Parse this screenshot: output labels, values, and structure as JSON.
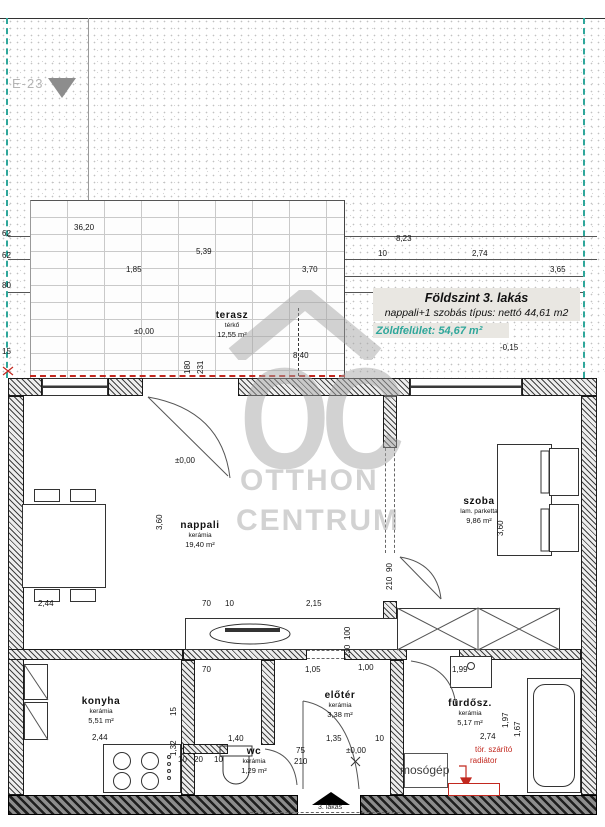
{
  "header": {
    "plan_code": "E-23"
  },
  "title_block": {
    "title": "Földszint 3. lakás",
    "subtitle": "nappali+1 szobás típus: nettó 44,61 m2",
    "green_label": "Zöldfelület:",
    "green_value": "54,67 m²"
  },
  "watermark": {
    "logo_text": "OC",
    "line1": "OTTHON",
    "line2": "CENTRUM"
  },
  "rooms": [
    {
      "id": "terasz",
      "name": "terasz",
      "floor": "térkő",
      "area": "12,55 m²",
      "x": 232,
      "y": 310
    },
    {
      "id": "nappali",
      "name": "nappali",
      "floor": "kerámia",
      "area": "19,40 m²",
      "x": 200,
      "y": 520
    },
    {
      "id": "szoba",
      "name": "szoba",
      "floor": "lam. parketta",
      "area": "9,86 m²",
      "x": 479,
      "y": 496
    },
    {
      "id": "konyha",
      "name": "konyha",
      "floor": "kerámia",
      "area": "5,51 m²",
      "x": 101,
      "y": 696
    },
    {
      "id": "eloter",
      "name": "előtér",
      "floor": "kerámia",
      "area": "3,38 m²",
      "x": 340,
      "y": 690
    },
    {
      "id": "wc",
      "name": "wc",
      "floor": "kerámia",
      "area": "1,29 m²",
      "x": 254,
      "y": 746
    },
    {
      "id": "furdo",
      "name": "fürdősz.",
      "floor": "kerámia",
      "area": "5,17 m²",
      "x": 470,
      "y": 698
    }
  ],
  "annotations": {
    "washing_machine": "mosógép",
    "radiator_line1": "tör. szárító",
    "radiator_line2": "radiátor",
    "unit_label": "3. lakás"
  },
  "dimensions": [
    {
      "t": "36,20",
      "x": 74,
      "y": 224
    },
    {
      "t": "8,23",
      "x": 396,
      "y": 235
    },
    {
      "t": "5,39",
      "x": 196,
      "y": 248
    },
    {
      "t": "10",
      "x": 378,
      "y": 250
    },
    {
      "t": "2,74",
      "x": 472,
      "y": 250
    },
    {
      "t": "1,85",
      "x": 126,
      "y": 266
    },
    {
      "t": "3,70",
      "x": 302,
      "y": 266
    },
    {
      "t": "3,65",
      "x": 550,
      "y": 266
    },
    {
      "t": "62",
      "x": 2,
      "y": 230
    },
    {
      "t": "62",
      "x": 2,
      "y": 252
    },
    {
      "t": "80",
      "x": 2,
      "y": 282
    },
    {
      "t": "15",
      "x": 2,
      "y": 348
    },
    {
      "t": "±0,00",
      "x": 134,
      "y": 328
    },
    {
      "t": "8,40",
      "x": 293,
      "y": 352
    },
    {
      "t": "-0,15",
      "x": 500,
      "y": 344
    },
    {
      "t": "180",
      "x": 184,
      "y": 374,
      "r": 1
    },
    {
      "t": "231",
      "x": 197,
      "y": 374,
      "r": 1
    },
    {
      "t": "±0,00",
      "x": 175,
      "y": 457
    },
    {
      "t": "3,60",
      "x": 156,
      "y": 530,
      "r": 1
    },
    {
      "t": "3,60",
      "x": 497,
      "y": 536,
      "r": 1
    },
    {
      "t": "90",
      "x": 386,
      "y": 572,
      "r": 1
    },
    {
      "t": "210",
      "x": 386,
      "y": 590,
      "r": 1
    },
    {
      "t": "2,44",
      "x": 38,
      "y": 600
    },
    {
      "t": "70",
      "x": 202,
      "y": 600
    },
    {
      "t": "10",
      "x": 225,
      "y": 600
    },
    {
      "t": "2,15",
      "x": 306,
      "y": 600
    },
    {
      "t": "100",
      "x": 344,
      "y": 640,
      "r": 1
    },
    {
      "t": "230",
      "x": 344,
      "y": 658,
      "r": 1
    },
    {
      "t": "70",
      "x": 202,
      "y": 666
    },
    {
      "t": "1,05",
      "x": 305,
      "y": 666
    },
    {
      "t": "1,00",
      "x": 358,
      "y": 664
    },
    {
      "t": "1,99",
      "x": 452,
      "y": 666
    },
    {
      "t": "15",
      "x": 170,
      "y": 716,
      "r": 1
    },
    {
      "t": "1,32",
      "x": 170,
      "y": 756,
      "r": 1
    },
    {
      "t": "2,44",
      "x": 92,
      "y": 734
    },
    {
      "t": "1,40",
      "x": 228,
      "y": 735
    },
    {
      "t": "10",
      "x": 178,
      "y": 756
    },
    {
      "t": "20",
      "x": 194,
      "y": 756
    },
    {
      "t": "10",
      "x": 214,
      "y": 756
    },
    {
      "t": "1,35",
      "x": 326,
      "y": 735
    },
    {
      "t": "10",
      "x": 375,
      "y": 735
    },
    {
      "t": "75",
      "x": 296,
      "y": 747
    },
    {
      "t": "210",
      "x": 294,
      "y": 758
    },
    {
      "t": "±0,00",
      "x": 346,
      "y": 747
    },
    {
      "t": "2,74",
      "x": 480,
      "y": 733
    },
    {
      "t": "1,97",
      "x": 502,
      "y": 728,
      "r": 1
    },
    {
      "t": "1,67",
      "x": 514,
      "y": 737,
      "r": 1
    }
  ],
  "colors": {
    "accent_teal": "#2fa79b",
    "marker_red": "#c2281f",
    "watermark_gray": "#a6a6a6"
  }
}
